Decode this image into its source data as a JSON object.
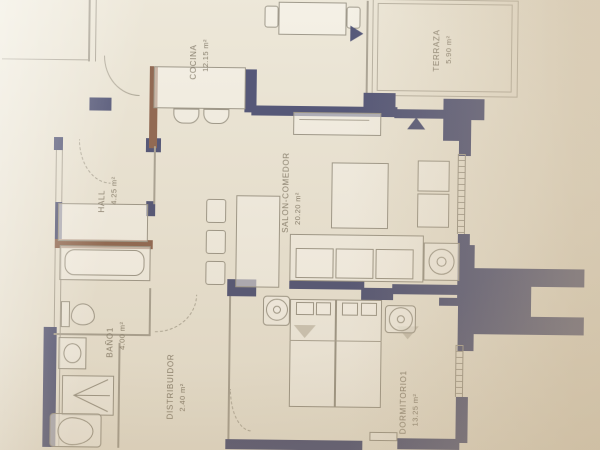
{
  "plan": {
    "rooms": [
      {
        "name": "COCINA",
        "area": "12.15 m²"
      },
      {
        "name": "TERRAZA",
        "area": "5.90 m²"
      },
      {
        "name": "HALL",
        "area": "4.25 m²"
      },
      {
        "name": "SALON-COMEDOR",
        "area": "20.20 m²"
      },
      {
        "name": "BAÑO1",
        "area": "4.00 m²"
      },
      {
        "name": "DISTRIBUIDOR",
        "area": "2.40 m²"
      },
      {
        "name": "DORMITORIO1",
        "area": "13.25 m²"
      }
    ],
    "colors": {
      "wall_navy": "#2f3460",
      "wall_brown": "#7a4a32",
      "paper": "#e9e3d3",
      "photo_tint": "#d6c8b2",
      "furniture_line": "#8b8576",
      "label_text": "#6f6654"
    }
  }
}
